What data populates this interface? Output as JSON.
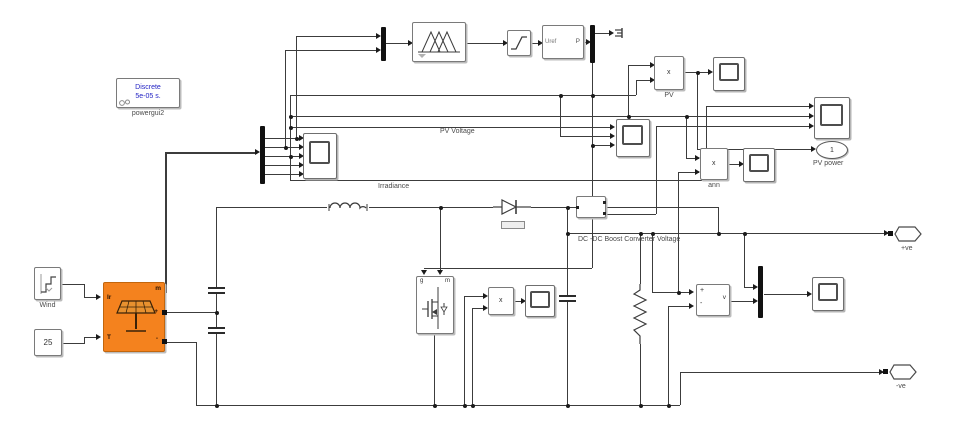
{
  "canvas": {
    "background": "#ffffff",
    "wire_color": "#3c3c3c",
    "pv_array_color": "#f4821e",
    "powergui_text_color": "#2424c4"
  },
  "blocks": {
    "powergui": {
      "line1": "Discrete",
      "line2": "5e-05 s.",
      "label": "powergui2"
    },
    "wind_source": {
      "label": "Wind"
    },
    "temperature_constant": {
      "value": "25"
    },
    "pv_array": {
      "ports": {
        "irradiance": "Ir",
        "temperature": "T",
        "measurement": "m",
        "positive": "+",
        "negative": "-"
      }
    },
    "pwm_generator": {
      "input_label": "Uref",
      "output_label": "P"
    },
    "product_pv": {
      "symbol": "x",
      "label": "PV"
    },
    "product_ann": {
      "symbol": "x",
      "label": "ann"
    },
    "product_mosfet": {
      "symbol": "x"
    },
    "mosfet": {
      "gate": "g",
      "measurement": "m"
    },
    "voltage_measurement": {
      "plus": "+",
      "minus": "-",
      "output": "v"
    },
    "outport_pv_power": {
      "number": "1",
      "label": "PV power"
    },
    "port_positive": {
      "number": "1",
      "label": "+ve"
    },
    "port_negative": {
      "number": "2",
      "label": "-ve"
    }
  },
  "wire_labels": {
    "pv_voltage": "PV Voltage",
    "irradiance": "Irradiance",
    "boost_voltage": "DC -DC Boost Converter Voltage"
  }
}
